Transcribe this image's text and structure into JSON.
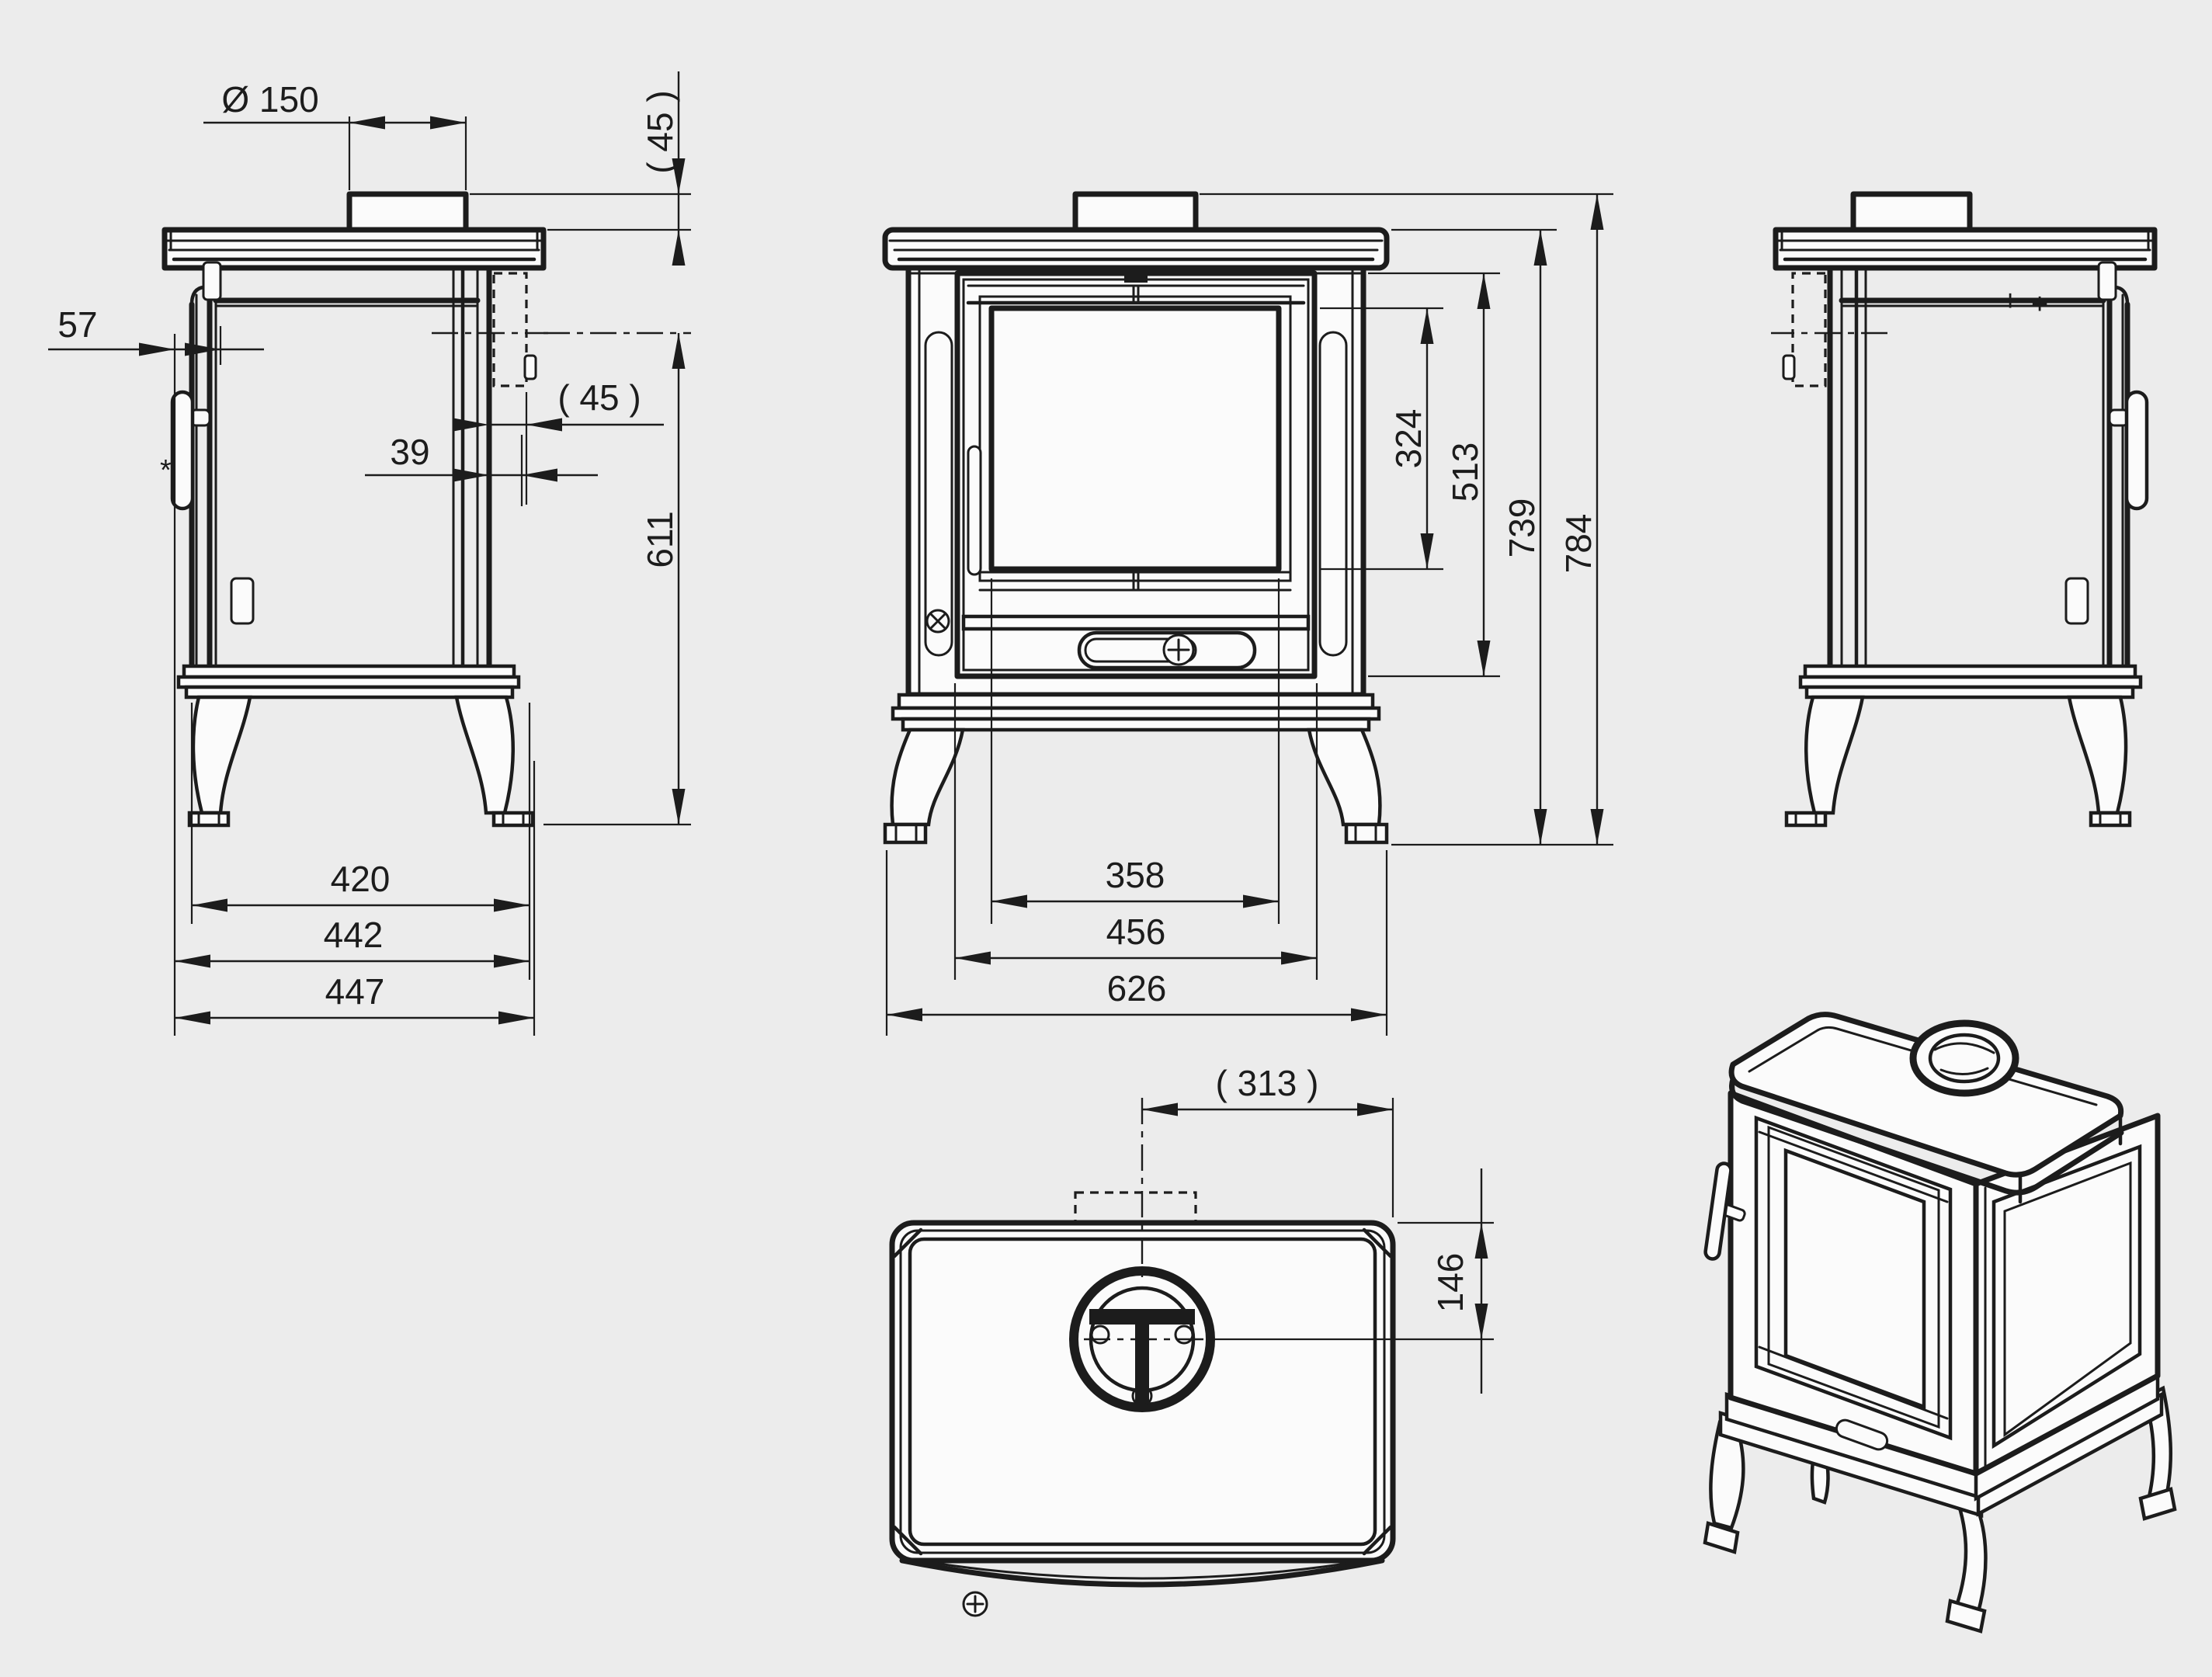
{
  "drawing": {
    "kind": "technical dimensional drawing",
    "subject": "cast-iron wood stove, four orthographic views and one isometric view",
    "background_color": "#ececec",
    "line_color": "#1c1c1c"
  },
  "dims": {
    "side": {
      "flue_diameter": "Ø 150",
      "collar_height": "( 45 )",
      "handle_clearance": "57",
      "shield_gap_outer": "( 45 )",
      "shield_gap_inner": "39",
      "outlet_height": "611",
      "depth_body": "420",
      "depth_with_handle": "442",
      "depth_overall": "447",
      "note": "*"
    },
    "front": {
      "glass_height": "324",
      "door_height": "513",
      "body_height": "739",
      "overall_height": "784",
      "glass_width": "358",
      "door_width": "456",
      "overall_width": "626"
    },
    "top": {
      "flue_offset": "( 313 )",
      "flue_from_rear": "146"
    },
    "right": {
      "adjuster_marks": [
        "+",
        "+"
      ]
    }
  }
}
